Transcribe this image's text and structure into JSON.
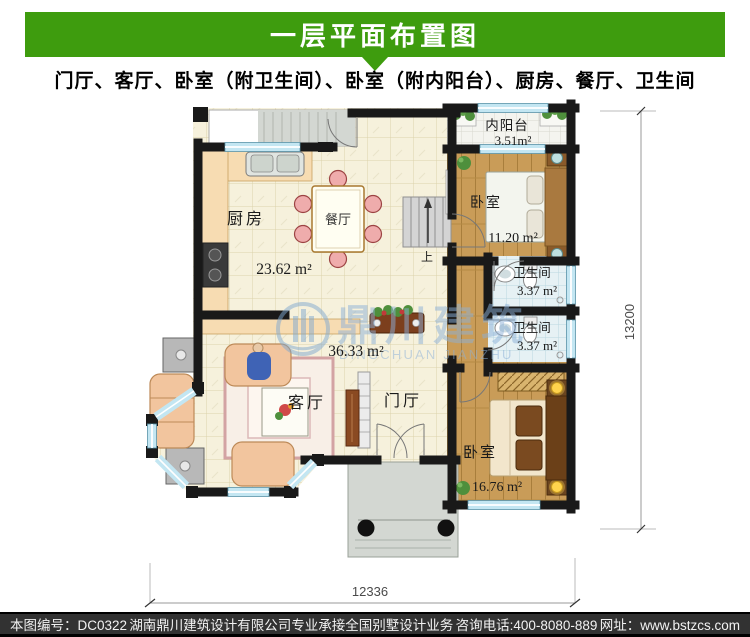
{
  "header": {
    "title": "一层平面布置图",
    "subtitle": "门厅、客厅、卧室（附卫生间）、卧室（附内阳台）、厨房、餐厅、卫生间"
  },
  "plan": {
    "rooms": {
      "kitchen": {
        "label": "厨房"
      },
      "dining": {
        "label": "餐厅"
      },
      "kitchen_dining": {
        "area": "23.62 m²"
      },
      "balcony": {
        "label": "内阳台",
        "area": "3.51m²"
      },
      "bedroom1": {
        "label": "卧室",
        "area": "11.20 m²"
      },
      "bath1": {
        "label": "卫生间",
        "area": "3.37 m²"
      },
      "bath2": {
        "label": "卫生间",
        "area": "3.37 m²"
      },
      "living": {
        "label": "客厅",
        "area": "36.33 m²"
      },
      "foyer": {
        "label": "门厅"
      },
      "bedroom2": {
        "label": "卧室",
        "area": "16.76 m²"
      }
    },
    "stair_up": "上",
    "dim_width": "12336",
    "dim_height": "13200"
  },
  "watermark": {
    "cn": "鼎川建筑",
    "en": "DINGCHUAN JIANZHU"
  },
  "footer": {
    "plan_number": "本图编号：DC0322",
    "company": "湖南鼎川建筑设计有限公司专业承接全国别墅设计业务",
    "phone": "咨询电话:400-8080-889",
    "website": "网址：www.bstzcs.com"
  },
  "colors": {
    "accent_green": "#3e9c0e",
    "wall_black": "#191919",
    "watermark_blue": "#8cb0d8",
    "window_blue": "#c3e6f2"
  }
}
